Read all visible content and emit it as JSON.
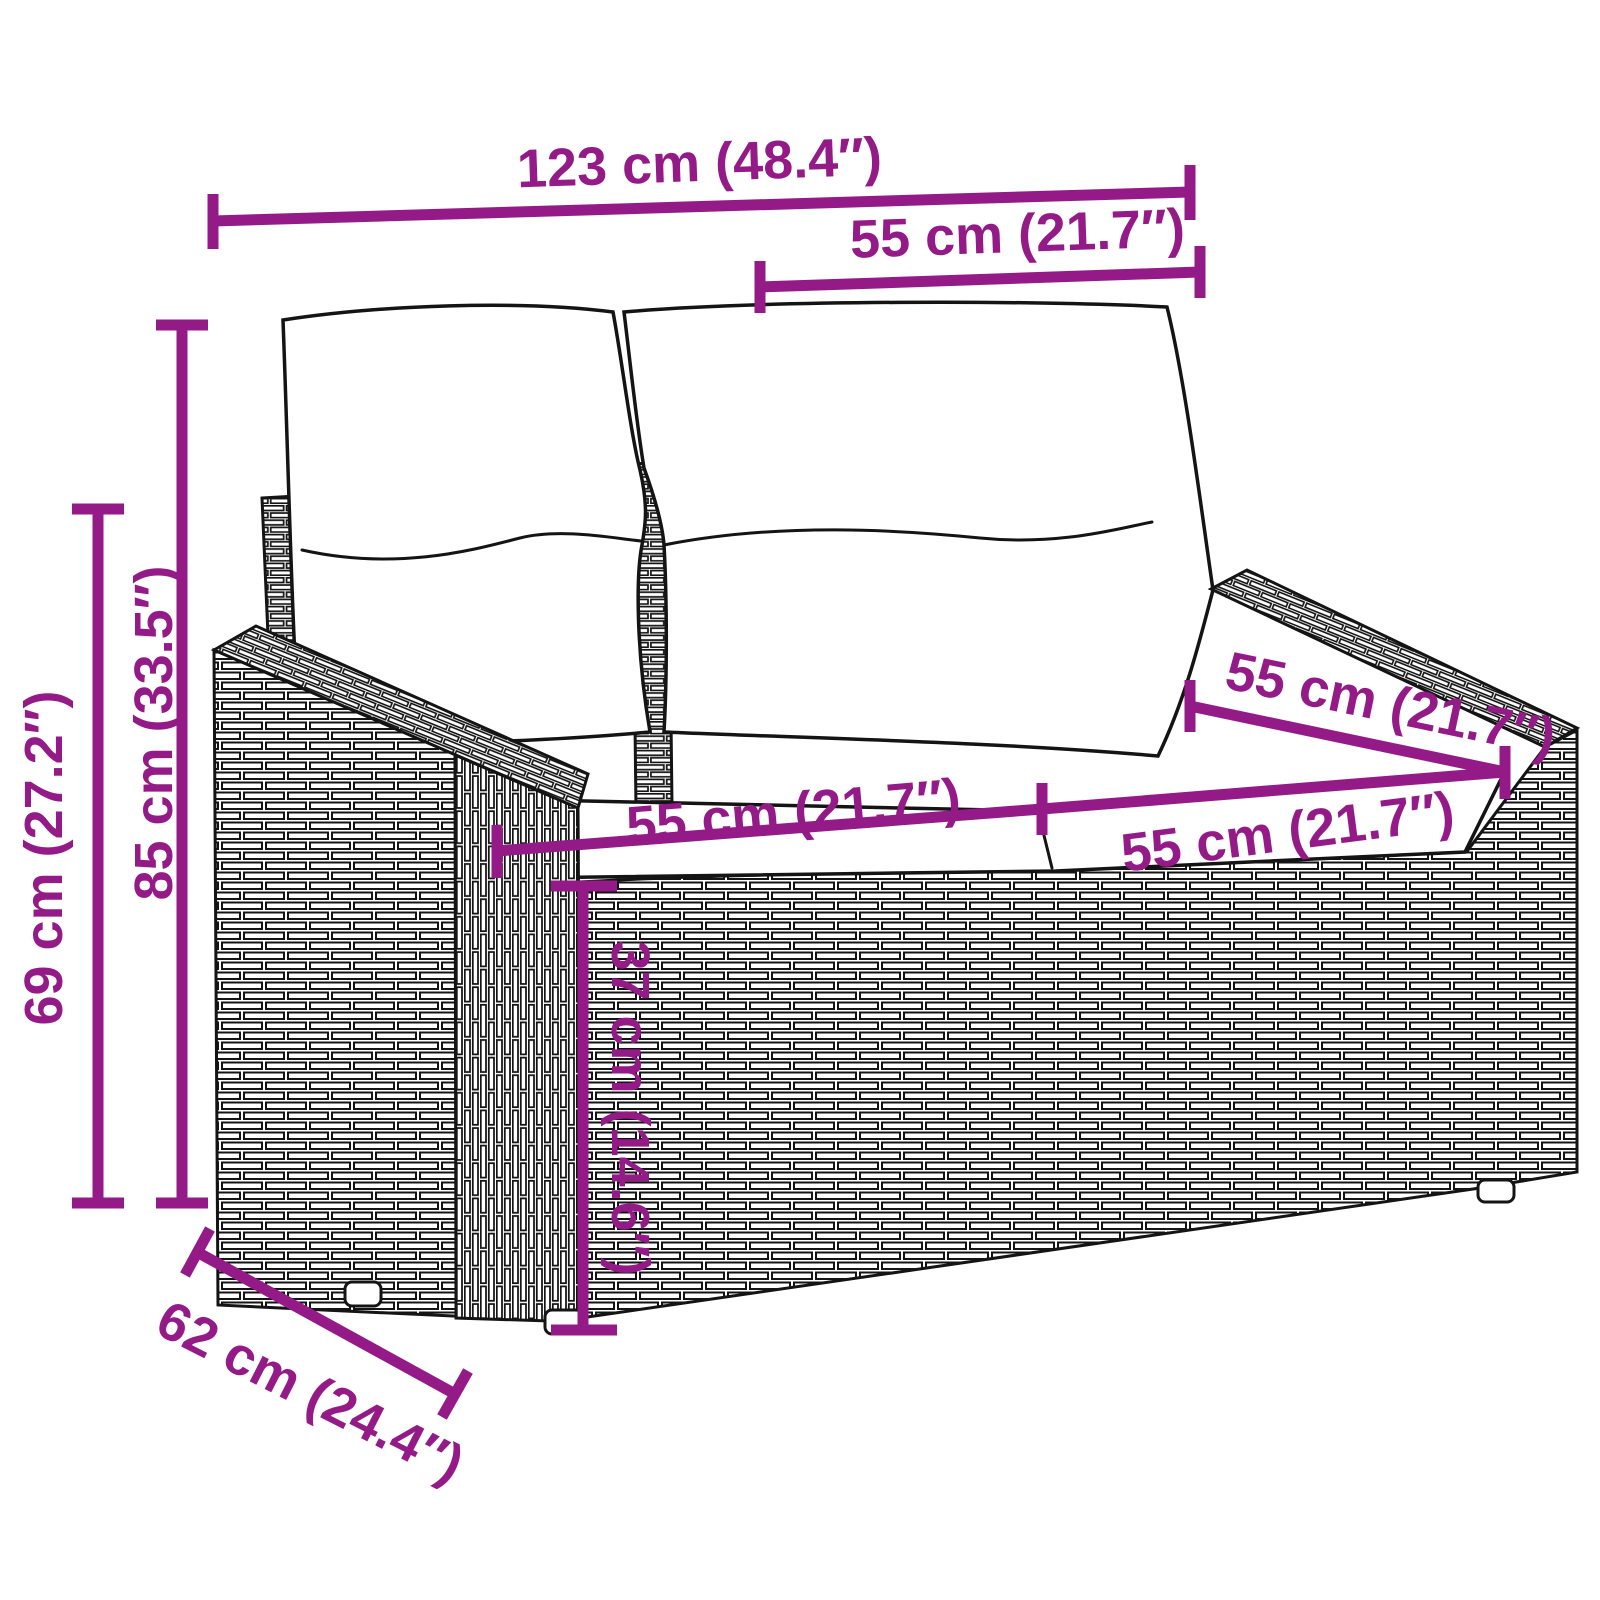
{
  "diagram": {
    "subject_colors": {
      "dimension_accent": "#941b87",
      "line_art": "#141414",
      "background": "#ffffff"
    },
    "labels": {
      "overall_width": "123 cm (48.4″)",
      "back_cushion_width": "55 cm (21.7″)",
      "overall_height": "85 cm (33.5″)",
      "frame_back_height": "69 cm (27.2″)",
      "seat_cushion_width_left": "55 cm (21.7″)",
      "seat_cushion_width_right": "55 cm (21.7″)",
      "seat_depth": "55 cm (21.7″)",
      "seat_height": "37 cm (14.6″)",
      "overall_depth": "62 cm (24.4″)"
    }
  }
}
